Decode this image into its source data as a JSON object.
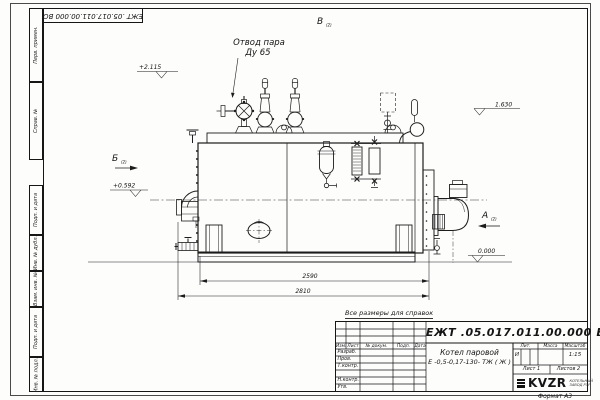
{
  "page": {
    "format_label": "Формат А3",
    "reference_note": "Все размеры для справок"
  },
  "frame": {
    "top_doc_number": "ЕЖТ .05.017.011.00.000  ВО",
    "margin_labels": [
      "Перв. примен.",
      "Справ. №",
      "Подп. и дата",
      "Инв. № дубл.",
      "Взам. инв. №",
      "Подп. и дата",
      "Инв. № подл."
    ]
  },
  "title_block": {
    "doc_number": "ЕЖТ .05.017.011.00.000  ВО",
    "product_name_line1": "Котел паровой",
    "product_name_line2": "Е -0,5-0,17-130- ТЖ ( Ж )",
    "header_cols": [
      "Изм.",
      "Лист",
      "№ докум.",
      "Подп.",
      "Дата"
    ],
    "sign_rows": [
      "Разраб.",
      "Пров.",
      "Т.контр.",
      "",
      "Н.контр.",
      "Утв."
    ],
    "lit_label": "Лит.",
    "lit_value": "И",
    "mass_label": "Масса",
    "scale_label": "Масштаб",
    "scale_value": "1:15",
    "sheet_label": "Лист",
    "sheet_value": "1",
    "sheets_label": "Листов",
    "sheets_value": "2",
    "logo_text": "KVZR",
    "logo_caption_line1": "КОТЕЛЬНЫЙ",
    "logo_caption_line2": "ЗАВОД РЭР"
  },
  "drawing": {
    "callout_line1": "Отвод пара",
    "callout_line2": "Ду 65",
    "dim_inner": "2590",
    "dim_outer": "2810",
    "level_top": "+2.115",
    "level_mid": "+0.592",
    "level_right": "1.630",
    "level_zero": "0.000",
    "view_a": "А",
    "view_b": "Б",
    "view_v": "В",
    "view_index": "(2)"
  }
}
